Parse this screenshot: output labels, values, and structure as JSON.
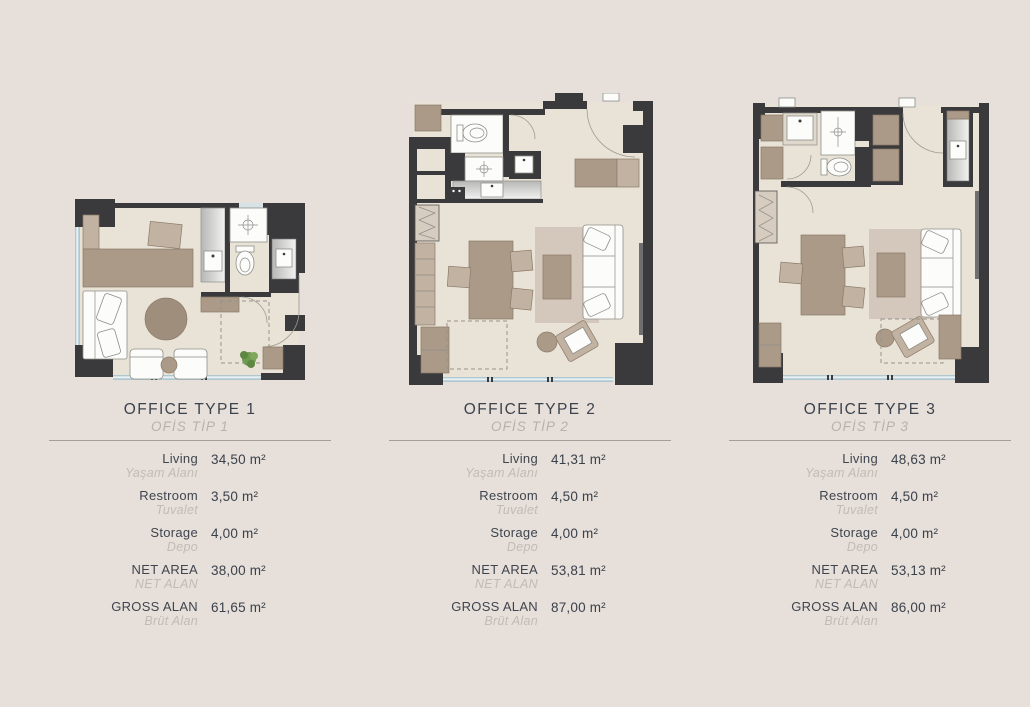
{
  "colors": {
    "page_background": "#e6dfda",
    "title_text": "#3d434d",
    "subtitle_text": "#b7b1ac",
    "value_text": "#3a414b",
    "muted_label_text": "#c1bbb5",
    "divider": "#a49e98",
    "plan_wall": "#3a3a3c",
    "plan_floor": "#e9e3d7",
    "plan_wood": "#ab9a88",
    "plan_rug": "#d3c8bb",
    "plan_window": "#aec7d0",
    "plan_plant": "#6f9b50"
  },
  "plans": [
    {
      "title": "OFFICE TYPE 1",
      "subtitle": "OFİS TİP 1",
      "rows": [
        {
          "label_en": "Living",
          "label_tr": "Yaşam Alanı",
          "value": "34,50 m²"
        },
        {
          "label_en": "Restroom",
          "label_tr": "Tuvalet",
          "value": "3,50 m²"
        },
        {
          "label_en": "Storage",
          "label_tr": "Depo",
          "value": "4,00 m²"
        },
        {
          "label_en": "NET AREA",
          "label_tr": "NET ALAN",
          "value": "38,00 m²"
        },
        {
          "label_en": "GROSS ALAN",
          "label_tr": "Brüt Alan",
          "value": "61,65 m²"
        }
      ]
    },
    {
      "title": "OFFICE TYPE 2",
      "subtitle": "OFİS TİP 2",
      "rows": [
        {
          "label_en": "Living",
          "label_tr": "Yaşam Alanı",
          "value": "41,31 m²"
        },
        {
          "label_en": "Restroom",
          "label_tr": "Tuvalet",
          "value": "4,50 m²"
        },
        {
          "label_en": "Storage",
          "label_tr": "Depo",
          "value": "4,00 m²"
        },
        {
          "label_en": "NET AREA",
          "label_tr": "NET ALAN",
          "value": "53,81 m²"
        },
        {
          "label_en": "GROSS ALAN",
          "label_tr": "Brüt Alan",
          "value": "87,00 m²"
        }
      ]
    },
    {
      "title": "OFFICE TYPE 3",
      "subtitle": "OFİS TİP 3",
      "rows": [
        {
          "label_en": "Living",
          "label_tr": "Yaşam Alanı",
          "value": "48,63 m²"
        },
        {
          "label_en": "Restroom",
          "label_tr": "Tuvalet",
          "value": "4,50 m²"
        },
        {
          "label_en": "Storage",
          "label_tr": "Depo",
          "value": "4,00 m²"
        },
        {
          "label_en": "NET AREA",
          "label_tr": "NET ALAN",
          "value": "53,13 m²"
        },
        {
          "label_en": "GROSS ALAN",
          "label_tr": "Brüt Alan",
          "value": "86,00 m²"
        }
      ]
    }
  ]
}
